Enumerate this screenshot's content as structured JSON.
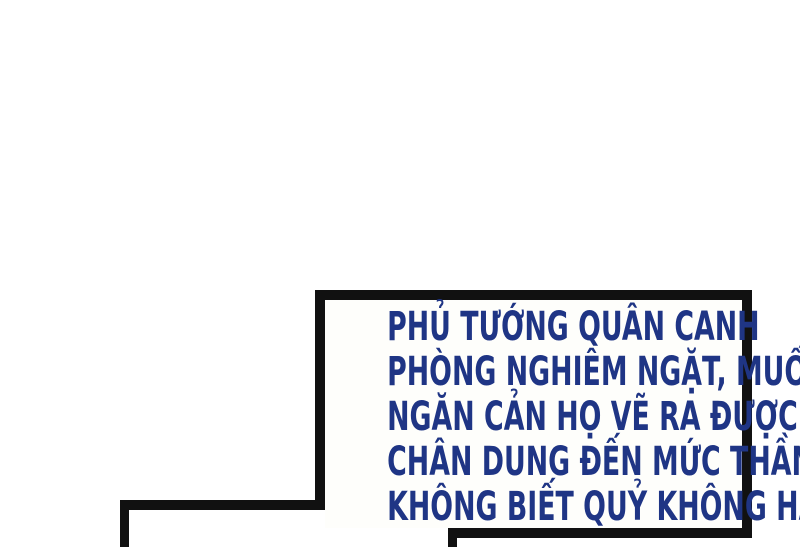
{
  "page": {
    "background_color": "#ffffff",
    "border_color": "#111111"
  },
  "speech_box": {
    "text_color": "#1f3585",
    "lines": [
      "PHỦ TƯỚNG QUÂN CANH",
      "PHÒNG NGHIÊM NGẶT, MUỐN",
      "NGĂN CẢN HỌ VẼ RA ĐƯỢC",
      "CHÂN DUNG ĐẾN MỨC THẦN",
      "KHÔNG BIẾT QUỶ KHÔNG HAY"
    ],
    "full_text": "PHỦ TƯỚNG QUÂN CANH PHÒNG NGHIÊM NGẶT, MUỐN NGĂN CẢN HỌ VẼ RA ĐƯỢC CHÂN DUNG ĐẾN MỨC THẦN KHÔNG BIẾT QUỶ KHÔNG HAY"
  }
}
